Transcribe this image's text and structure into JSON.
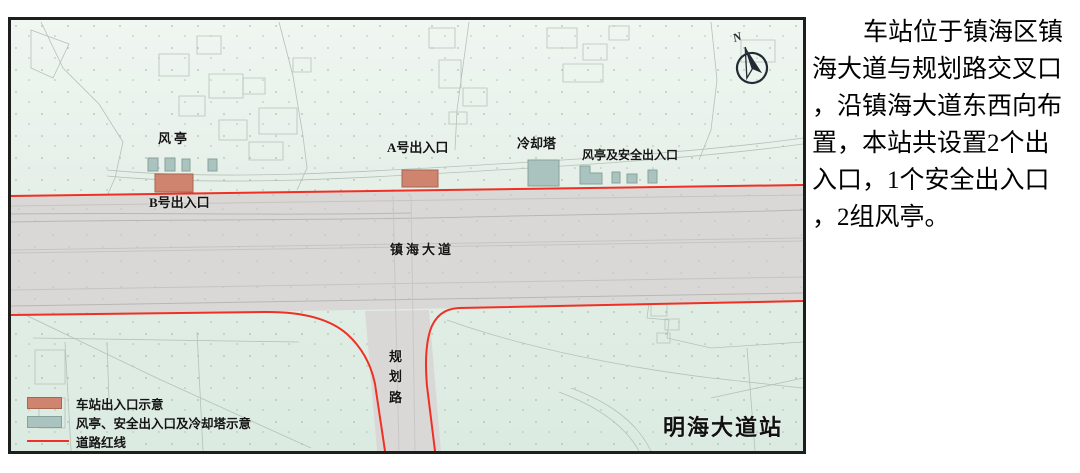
{
  "map": {
    "labels": {
      "wind_pavilion": "风亭",
      "entrance_a": "A号出入口",
      "entrance_b": "B号出入口",
      "cooling_tower": "冷却塔",
      "wind_safety_exit": "风亭及安全出入口",
      "avenue": "镇海大道",
      "planned_road_chars": [
        "规",
        "划",
        "路"
      ],
      "station_name": "明海大道站",
      "compass_n": "N"
    },
    "legend": [
      {
        "label": "车站出入口示意",
        "swatch_color": "#cf8470"
      },
      {
        "label": "风亭、安全出入口及冷却塔示意",
        "swatch_color": "#aac3be"
      },
      {
        "label": "道路红线",
        "swatch_color": "#ee3124"
      }
    ],
    "colors": {
      "entrance_fill": "#cf8470",
      "vent_fill": "#aac3be",
      "road_red_line": "#ee3124",
      "road_fill": "#dad8d6",
      "terrain_fill": "#e4efe8"
    }
  },
  "description": {
    "lines": [
      "车站位于镇海区镇",
      "海大道与规划路交叉口",
      "，沿镇海大道东西向布",
      "置，本站共设置2个出",
      "入口，1个安全出入口",
      "，2组风亭。"
    ]
  }
}
